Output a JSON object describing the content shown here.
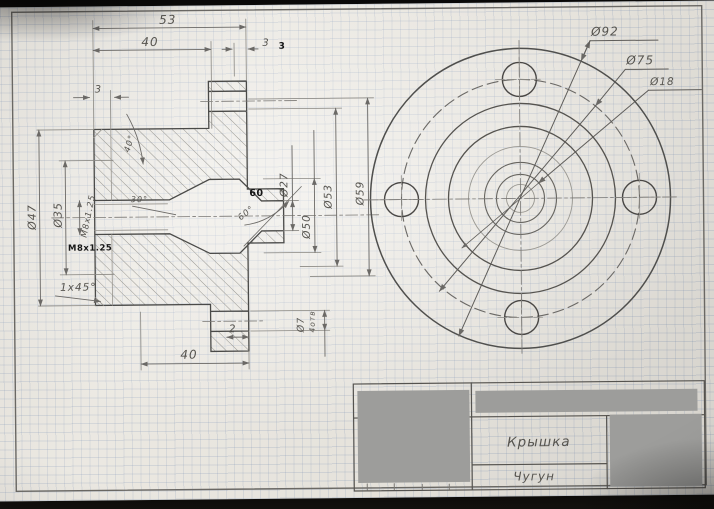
{
  "title_block": {
    "part_name": "Крышка",
    "material": "Чугун"
  },
  "front_view": {
    "d92": "Ø92",
    "d75": "Ø75",
    "d18": "Ø18"
  },
  "section_view": {
    "len_53": "53",
    "len_40_top": "40",
    "len_3_right": "3",
    "len_3_right_bold": "3",
    "len_3_left": "3",
    "d47": "Ø47",
    "d35": "Ø35",
    "thread": "М8х1.25",
    "thread_bold": "M8x1.25",
    "chamfer": "1х45°",
    "angle_40": "40°",
    "angle_30": "30°",
    "angle_60_bold": "60",
    "angle_60": "60°",
    "d27": "Ø27",
    "d50": "Ø50",
    "d53": "Ø53",
    "d59": "Ø59",
    "len_2": "2",
    "len_40_bottom": "40",
    "d7": "Ø7",
    "holes_count": "4отв"
  },
  "colors": {
    "pencil": "#5a5852",
    "bold_ink": "#161616",
    "paper": "#e9e6df",
    "redaction": "#9d9d9b",
    "grid": "#8fa3c0"
  }
}
